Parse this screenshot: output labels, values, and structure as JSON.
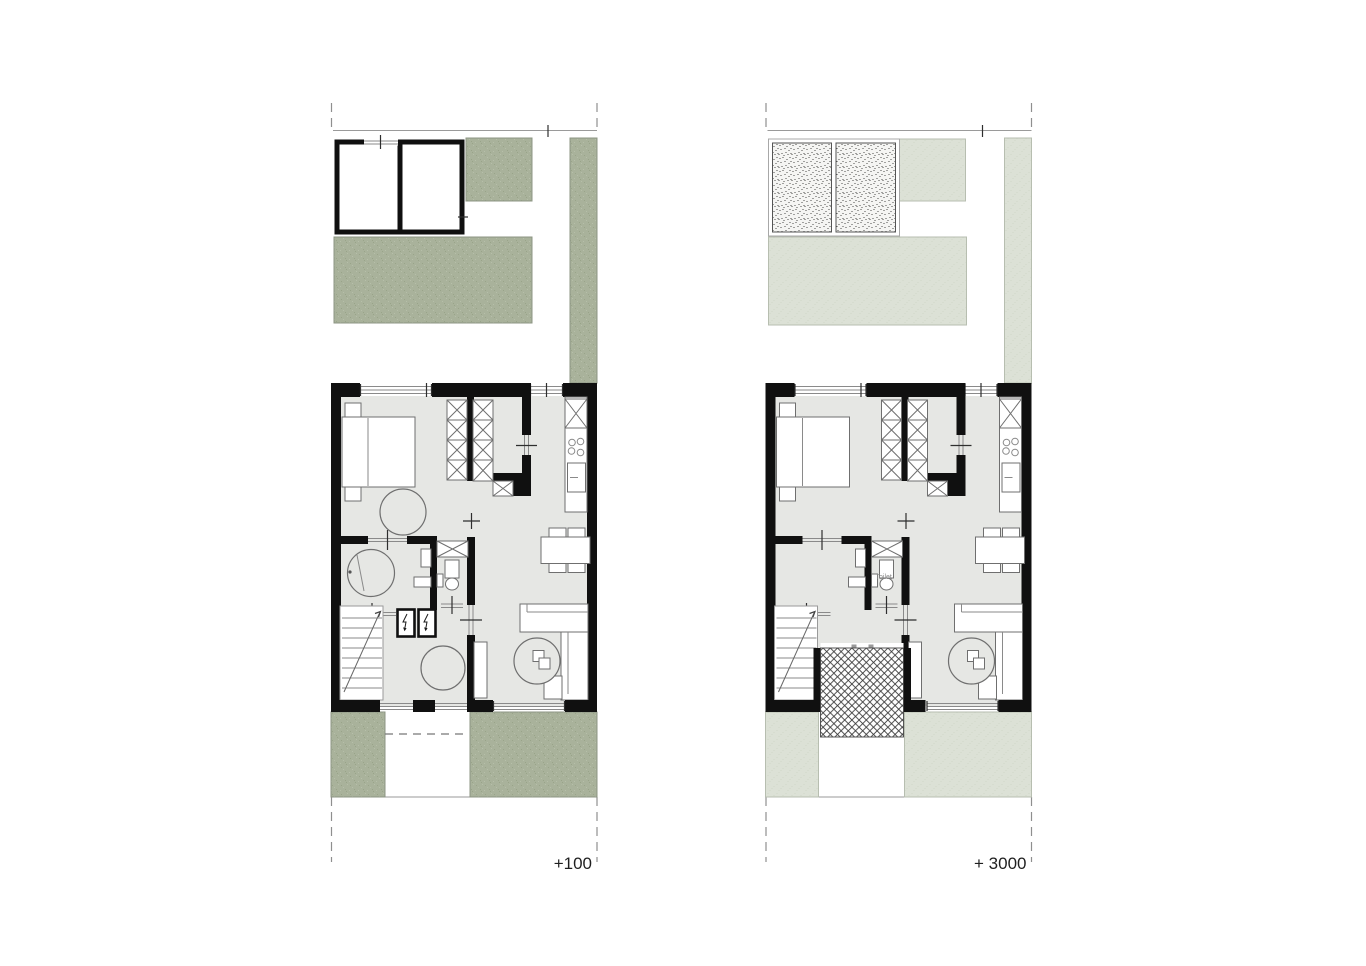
{
  "document": {
    "kind": "architectural floor plan sheet",
    "background": "#ffffff"
  },
  "plans": [
    {
      "id": "plan-left",
      "level_label": "+100",
      "garden_style": "dark-sage"
    },
    {
      "id": "plan-right",
      "level_label": "+ 3000",
      "toilet_label": "Toilet",
      "garden_style": "light-sage"
    }
  ],
  "icons": {
    "lightning_icon": "electric shaft symbol",
    "stair_arrow_icon": "stair direction arrow"
  },
  "palette": {
    "wall": "#101010",
    "floor": "#e6e7e4",
    "garden_dark": "#a9b29b",
    "garden_dark_dot": "#99a489",
    "garden_dark_dot2": "#b6bfa9",
    "garden_dark_stroke": "#8c9483",
    "garden_light": "#dce1d6",
    "garden_light_dot": "#cfd6c8",
    "garden_light_stroke": "#b7beb0",
    "line": "#8a8a8a",
    "furn_stroke": "#6f6f6f",
    "text": "#1f1f1f",
    "stipple_dot": "#4a4a4a",
    "hatch_line": "#3a3a3a"
  }
}
